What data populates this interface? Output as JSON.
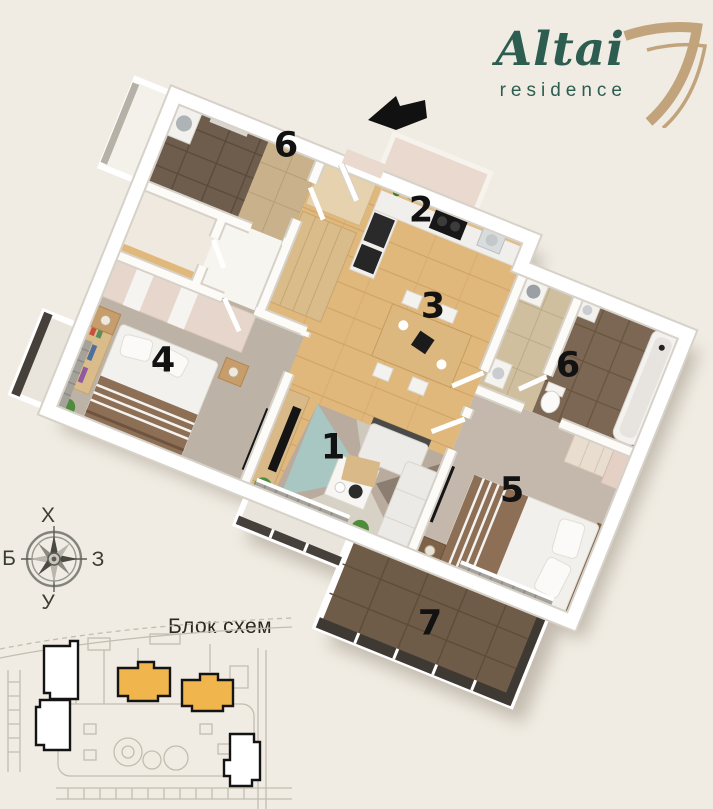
{
  "brand": {
    "title": "Altai",
    "subtitle": "residence",
    "title_color": "#2d5c50",
    "mark_color": "#c2a47c",
    "mark_icon": "gold-seven-icon"
  },
  "floor_plan": {
    "entrance_icon": "entrance-arrow",
    "labels": [
      "6",
      "2",
      "3",
      "4",
      "6",
      "1",
      "5",
      "7"
    ]
  },
  "compass": {
    "top": "Х",
    "left": "Б",
    "right": "З",
    "bottom": "У"
  },
  "site_plan": {
    "title": "Блок схем",
    "highlight_color": "#f0b54d"
  },
  "palette": {
    "page_background": "#f0ece3",
    "wood_floor": "#e0b87b",
    "carpet": "#bcb2a5",
    "dark_tile": "#6e5d4d",
    "brown_tile": "#7b6753",
    "balcony_tile": "#6f5c48",
    "wall": "#ffffff",
    "label_color": "#121212"
  }
}
